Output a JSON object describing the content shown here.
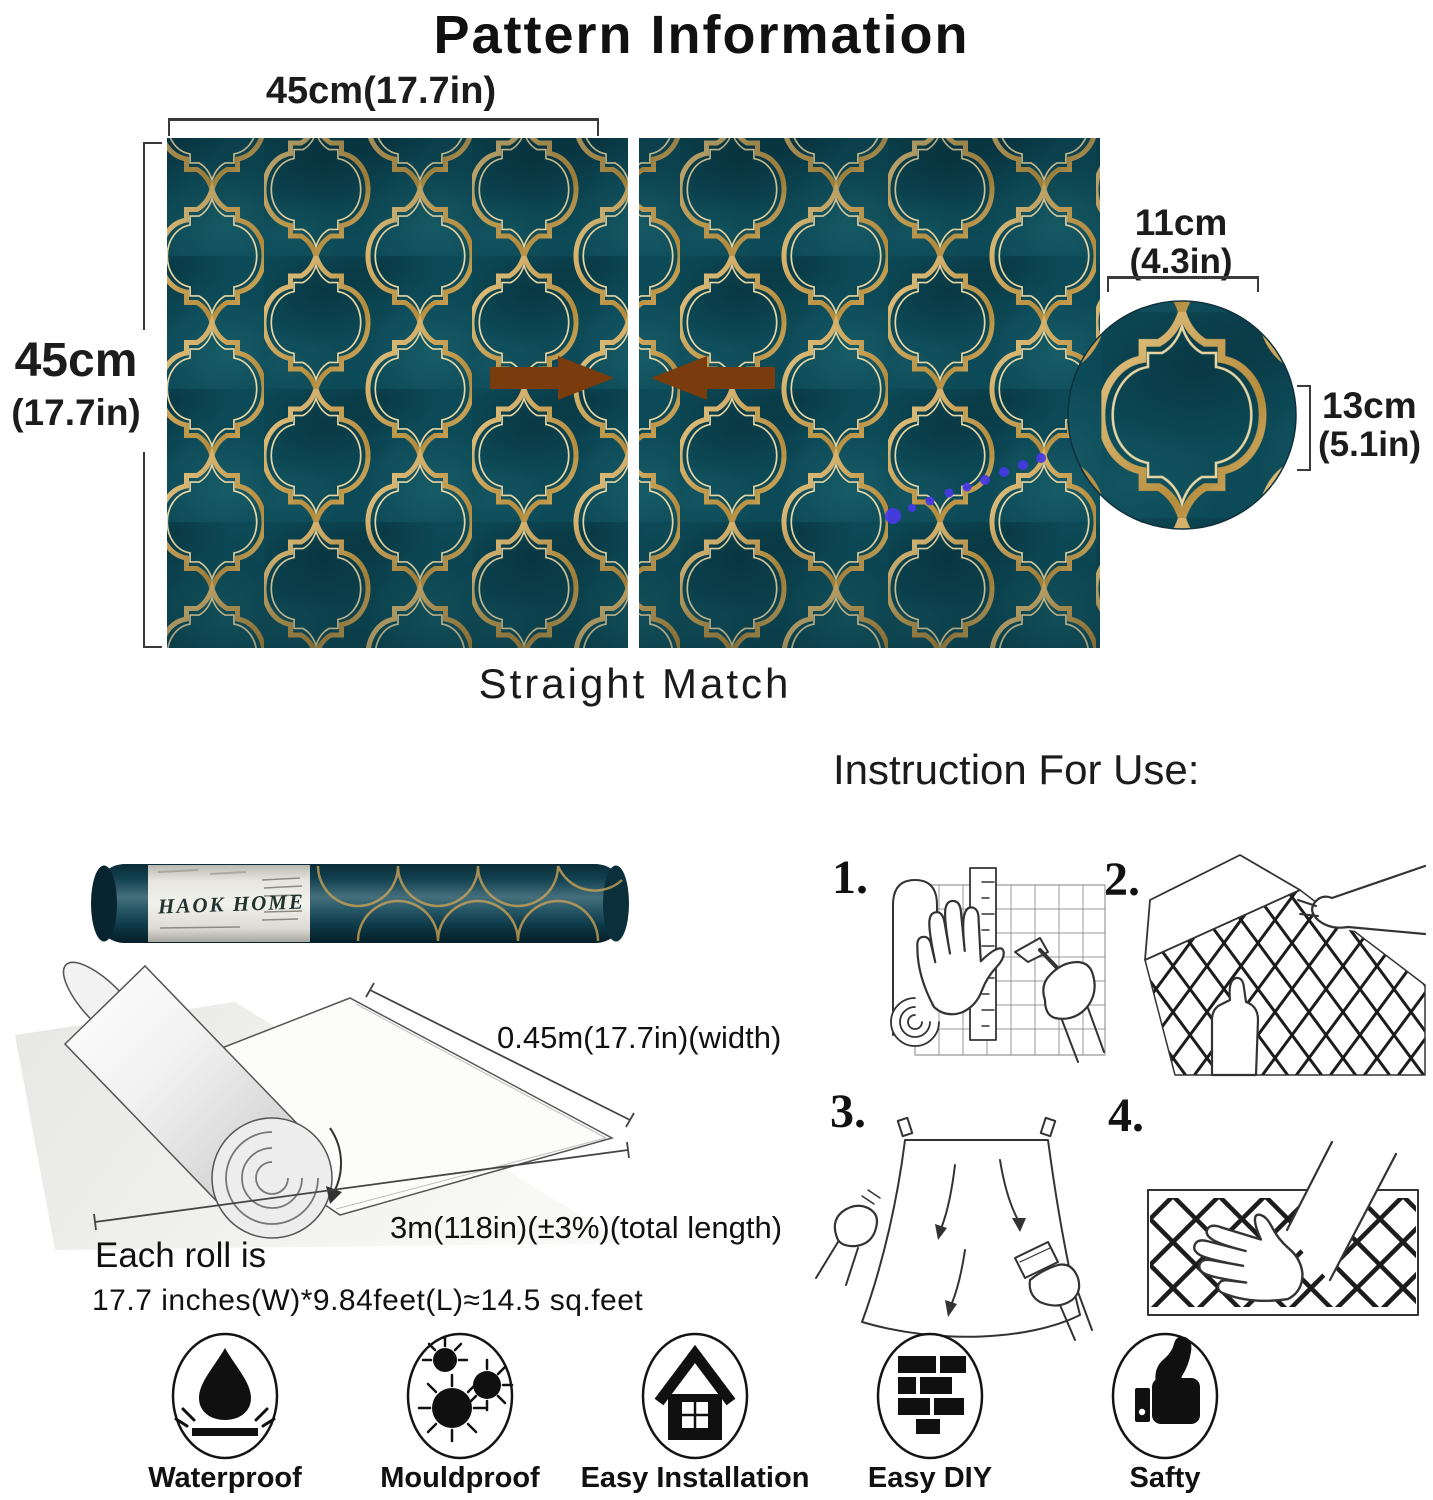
{
  "title": "Pattern Information",
  "pattern_diagram": {
    "top_width_label": "45cm(17.7in)",
    "left_height_cm": "45cm",
    "left_height_in": "(17.7in)",
    "detail_width_cm": "11cm",
    "detail_width_in": "(4.3in)",
    "detail_height_cm": "13cm",
    "detail_height_in": "(5.1in)",
    "match_label": "Straight Match"
  },
  "roll_info": {
    "brand": "HAOK HOME",
    "width_label": "0.45m(17.7in)(width)",
    "length_label": "3m(118in)(±3%)(total length)",
    "each_roll_line1": "Each roll is",
    "each_roll_line2": "17.7 inches(W)*9.84feet(L)≈14.5 sq.feet"
  },
  "instructions": {
    "heading": "Instruction For Use:",
    "steps": [
      {
        "number": "1.",
        "icon": "measure-and-cut"
      },
      {
        "number": "2.",
        "icon": "peel-backing"
      },
      {
        "number": "3.",
        "icon": "hang-and-smooth"
      },
      {
        "number": "4.",
        "icon": "press-flat"
      }
    ]
  },
  "features": [
    {
      "label": "Waterproof",
      "icon": "water-drop"
    },
    {
      "label": "Mouldproof",
      "icon": "mould-spores"
    },
    {
      "label": "Easy Installation",
      "icon": "house"
    },
    {
      "label": "Easy DIY",
      "icon": "bricks"
    },
    {
      "label": "Safty",
      "icon": "thumbs-up"
    }
  ],
  "colors": {
    "teal": "#0d4a57",
    "teal_dark": "#083844",
    "gold": "#c9a255",
    "gold_light": "#ecd9a5",
    "arrow_brown": "#7b3c0d",
    "dot_blue": "#4739e6"
  }
}
